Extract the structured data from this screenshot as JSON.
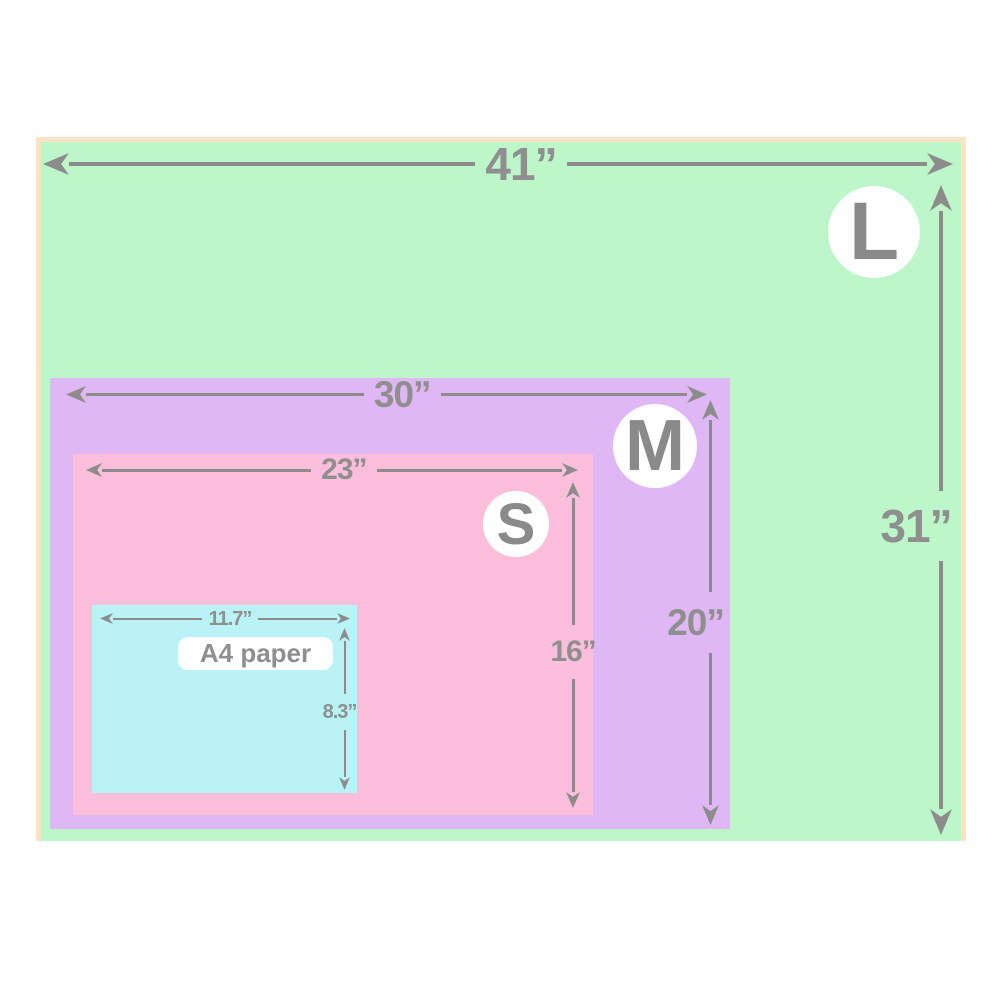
{
  "figure": {
    "name": "size-comparison-diagram",
    "background_color": "#ffffff",
    "line_color": "#8c8c8c",
    "label_color": "#8f8f8f",
    "frame_border_color": "#fce4c2",
    "badge_background": "#ffffff",
    "sizes": [
      {
        "code": "L",
        "width_label": "41”",
        "height_label": "31”",
        "fill": "#bcf6c9"
      },
      {
        "code": "M",
        "width_label": "30”",
        "height_label": "20”",
        "fill": "#deb7f4"
      },
      {
        "code": "S",
        "width_label": "23”",
        "height_label": "16”",
        "fill": "#fbbfdc"
      },
      {
        "code": "A4 paper",
        "width_label": "11.7”",
        "height_label": "8.3”",
        "fill": "#b9f3f5"
      }
    ]
  }
}
